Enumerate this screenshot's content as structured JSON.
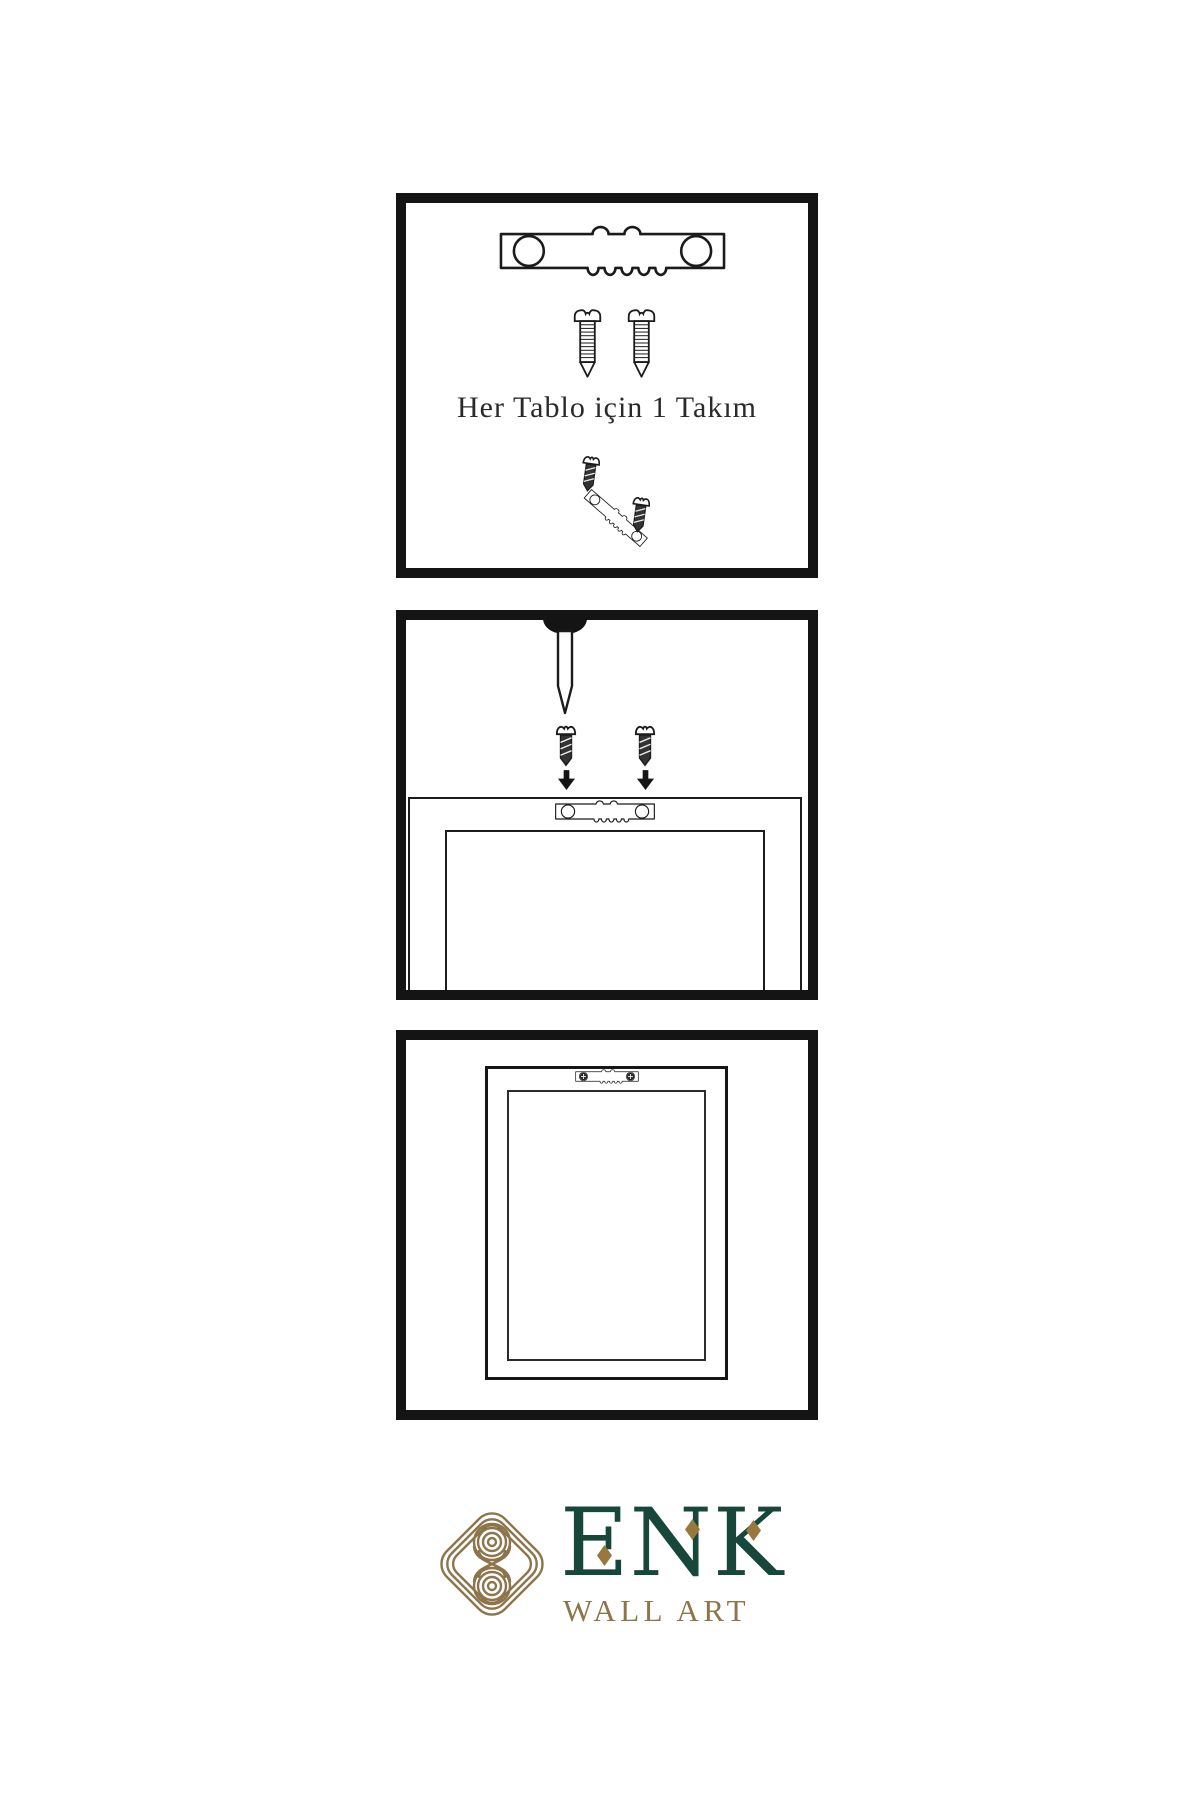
{
  "page": {
    "width": 1200,
    "height": 1800,
    "background": "#ffffff"
  },
  "colors": {
    "ink": "#1b1b1b",
    "panel_border": "#141414",
    "caption_text": "#2a2a2a",
    "screw_body_dark": "#333333",
    "brand_green": "#17463a",
    "brand_gold": "#8d744a",
    "diamond_gold": "#96793f"
  },
  "instructions": {
    "step1": {
      "caption": "Her Tablo için 1 Takım",
      "icons": [
        "sawtooth-hanger-icon",
        "screw-icon",
        "screw-icon",
        "screw-into-hanger-icon"
      ]
    },
    "step2": {
      "icons": [
        "wall-nail-icon",
        "screw-icon",
        "screw-icon",
        "down-arrow-icon",
        "down-arrow-icon",
        "frame-back-outline",
        "sawtooth-hanger-icon"
      ]
    },
    "step3": {
      "icons": [
        "mounted-frame-outline",
        "mounted-sawtooth-hanger-icon"
      ]
    }
  },
  "logo": {
    "brand": "ENK",
    "subtitle": "WALL ART",
    "symbol": "knot-logo-icon"
  }
}
